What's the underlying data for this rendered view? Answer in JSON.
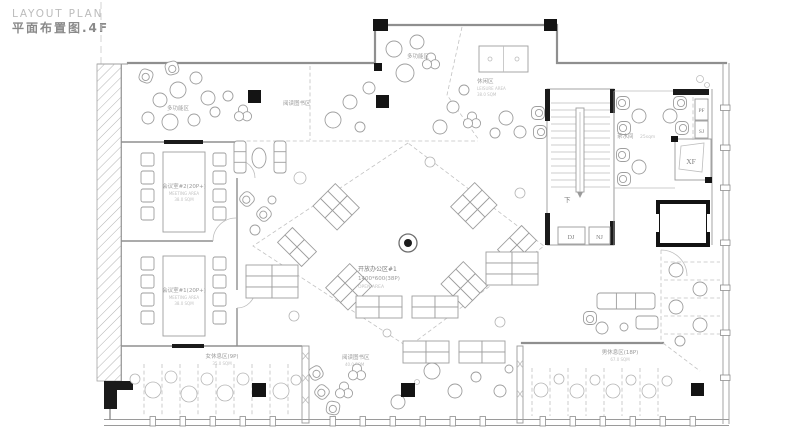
{
  "header": {
    "title_en": "LAYOUT PLAN",
    "title_cn": "平面布置图.4F"
  },
  "rooms": {
    "multi_top": {
      "cn": "多功能区"
    },
    "multi_left": {
      "cn": "多功能区"
    },
    "reading_top": {
      "cn": "阅读图书区"
    },
    "leisure": {
      "cn": "休闲区",
      "en": "LEISURE AREA",
      "area": "38.0 SQM"
    },
    "meeting2": {
      "cn": "会议室#2(20P+)",
      "en": "MEETING AREA",
      "area": "38.0 SQM"
    },
    "meeting1": {
      "cn": "会议室#1(20P+)",
      "en": "MEETING AREA",
      "area": "38.0 SQM"
    },
    "open_office": {
      "cn": "开放办公区#1",
      "spec": "1400*600(38P)",
      "en": "OPEN AREA"
    },
    "pantry": {
      "cn": "茶水间",
      "area": "25sqm"
    },
    "women_rest": {
      "cn": "女休息区(9P)",
      "area": "35.0 SQM"
    },
    "reading_bottom": {
      "cn": "阅读图书区",
      "area": "40.0 SQM"
    },
    "men_rest": {
      "cn": "男休息区(18P)",
      "area": "67.0 SQM"
    }
  },
  "annotations": {
    "stair_down": "下",
    "dj": "DJ",
    "nj": "NJ",
    "xf": "XF",
    "pf": "PF",
    "sj": "SJ"
  },
  "colors": {
    "wall": "#8f8f8f",
    "furniture_line": "#9e9e9e",
    "column": "#141414",
    "text": "#7d7d7d",
    "text_light": "#c3c3c3"
  }
}
